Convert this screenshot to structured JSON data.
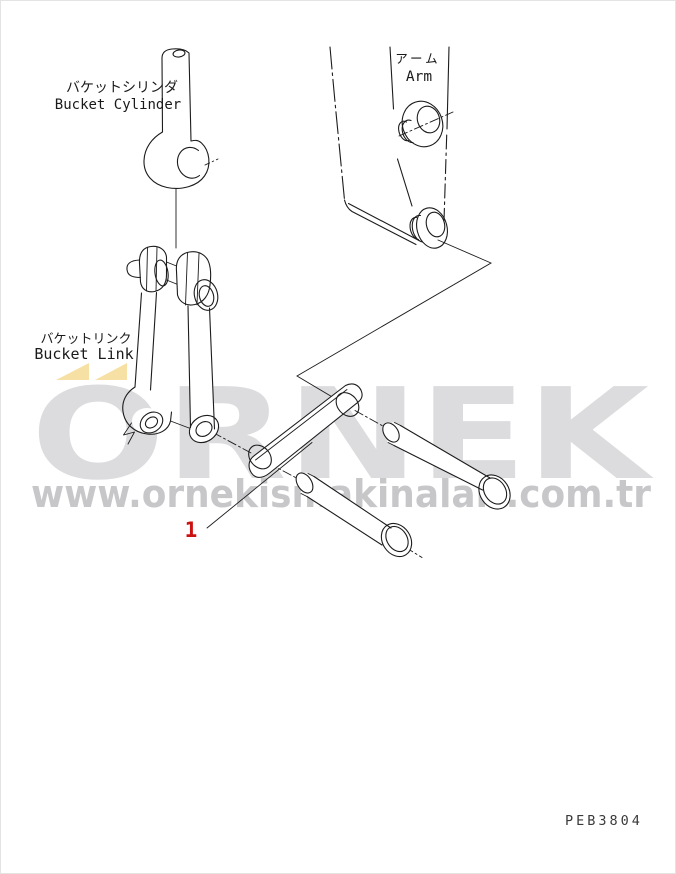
{
  "page": {
    "background": "#ffffff"
  },
  "labels": {
    "bucket_cylinder_jp": "バケットシリンダ",
    "bucket_cylinder_en": "Bucket Cylinder",
    "arm_jp": "アーム",
    "arm_en": "Arm",
    "bucket_link_jp": "バケットリンク",
    "bucket_link_en": "Bucket Link",
    "part_number": "1",
    "drawing_code": "PEB3804"
  },
  "watermark": {
    "brand": "ORNEK",
    "url": "www.ornekismakinalari.com.tr",
    "brand_color": "#dcdcdf",
    "url_color": "#c7c7ca",
    "accent_color": "#f7e0a3"
  },
  "colors": {
    "line": "#1c1c1c",
    "part_number": "#cc1111",
    "drawing_code": "#3a3a3a"
  }
}
